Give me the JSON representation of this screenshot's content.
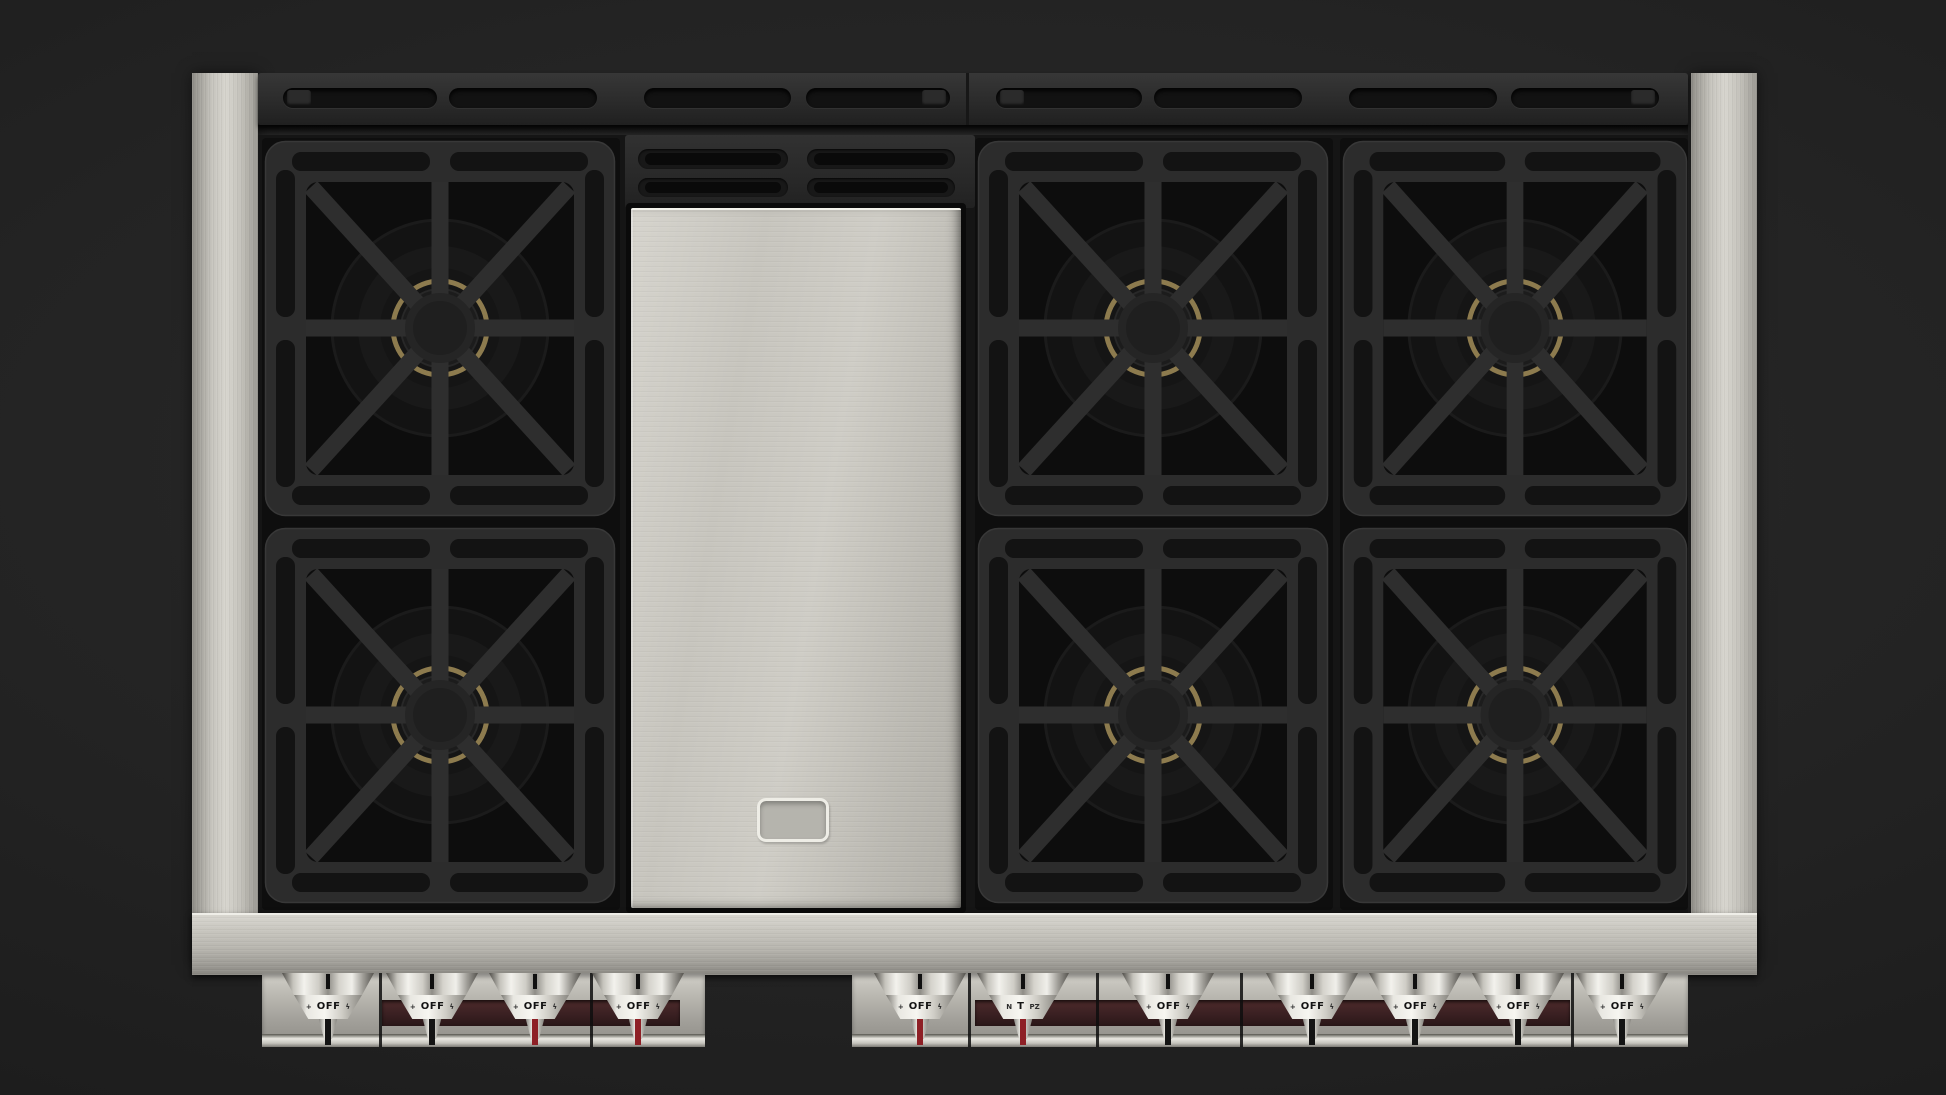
{
  "scene": {
    "subject": "Stainless steel professional gas rangetop, top-down product view",
    "burner_count": 6,
    "griddle_present": true,
    "background_color": "#222222"
  },
  "palette": {
    "stainless": "#c9c7c0",
    "stainless_bright": "#f2f1ea",
    "panel_black": "#2b2b2b",
    "cutout_black": "#121212",
    "brass_ring": "#8d7b4e",
    "recess_maroon": "#3a2022",
    "stem_red": "#8e2026",
    "stem_black": "#141414",
    "knob_metal": "#e9e8e2"
  },
  "top_panel": {
    "slot_count": 8,
    "hinge_cap_count": 4
  },
  "griddle_vents": {
    "slot_count": 4
  },
  "griddle_badge": {
    "present": true,
    "text": ""
  },
  "burners": [
    {
      "x": 264,
      "y": 140,
      "w": 352,
      "h": 377
    },
    {
      "x": 264,
      "y": 527,
      "w": 352,
      "h": 377
    },
    {
      "x": 977,
      "y": 140,
      "w": 352,
      "h": 377
    },
    {
      "x": 977,
      "y": 527,
      "w": 352,
      "h": 377
    },
    {
      "x": 1342,
      "y": 140,
      "w": 346,
      "h": 377
    },
    {
      "x": 1342,
      "y": 527,
      "w": 346,
      "h": 377
    }
  ],
  "knobs": [
    {
      "label": "OFF",
      "left": "+",
      "right": "ϟ",
      "stem": "black",
      "cx": 328
    },
    {
      "label": "OFF",
      "left": "+",
      "right": "ϟ",
      "stem": "black",
      "cx": 432
    },
    {
      "label": "OFF",
      "left": "+",
      "right": "ϟ",
      "stem": "red",
      "cx": 535
    },
    {
      "label": "OFF",
      "left": "+",
      "right": "ϟ",
      "stem": "red",
      "cx": 638
    },
    {
      "label": "OFF",
      "left": "+",
      "right": "ϟ",
      "stem": "red",
      "cx": 920
    },
    {
      "label": "T",
      "left": "N",
      "right": "PZ",
      "stem": "red",
      "cx": 1023
    },
    {
      "label": "OFF",
      "left": "+",
      "right": "ϟ",
      "stem": "black",
      "cx": 1168
    },
    {
      "label": "OFF",
      "left": "+",
      "right": "ϟ",
      "stem": "black",
      "cx": 1312
    },
    {
      "label": "OFF",
      "left": "+",
      "right": "ϟ",
      "stem": "black",
      "cx": 1415
    },
    {
      "label": "OFF",
      "left": "+",
      "right": "ϟ",
      "stem": "black",
      "cx": 1518
    },
    {
      "label": "OFF",
      "left": "+",
      "right": "ϟ",
      "stem": "black",
      "cx": 1622
    }
  ]
}
